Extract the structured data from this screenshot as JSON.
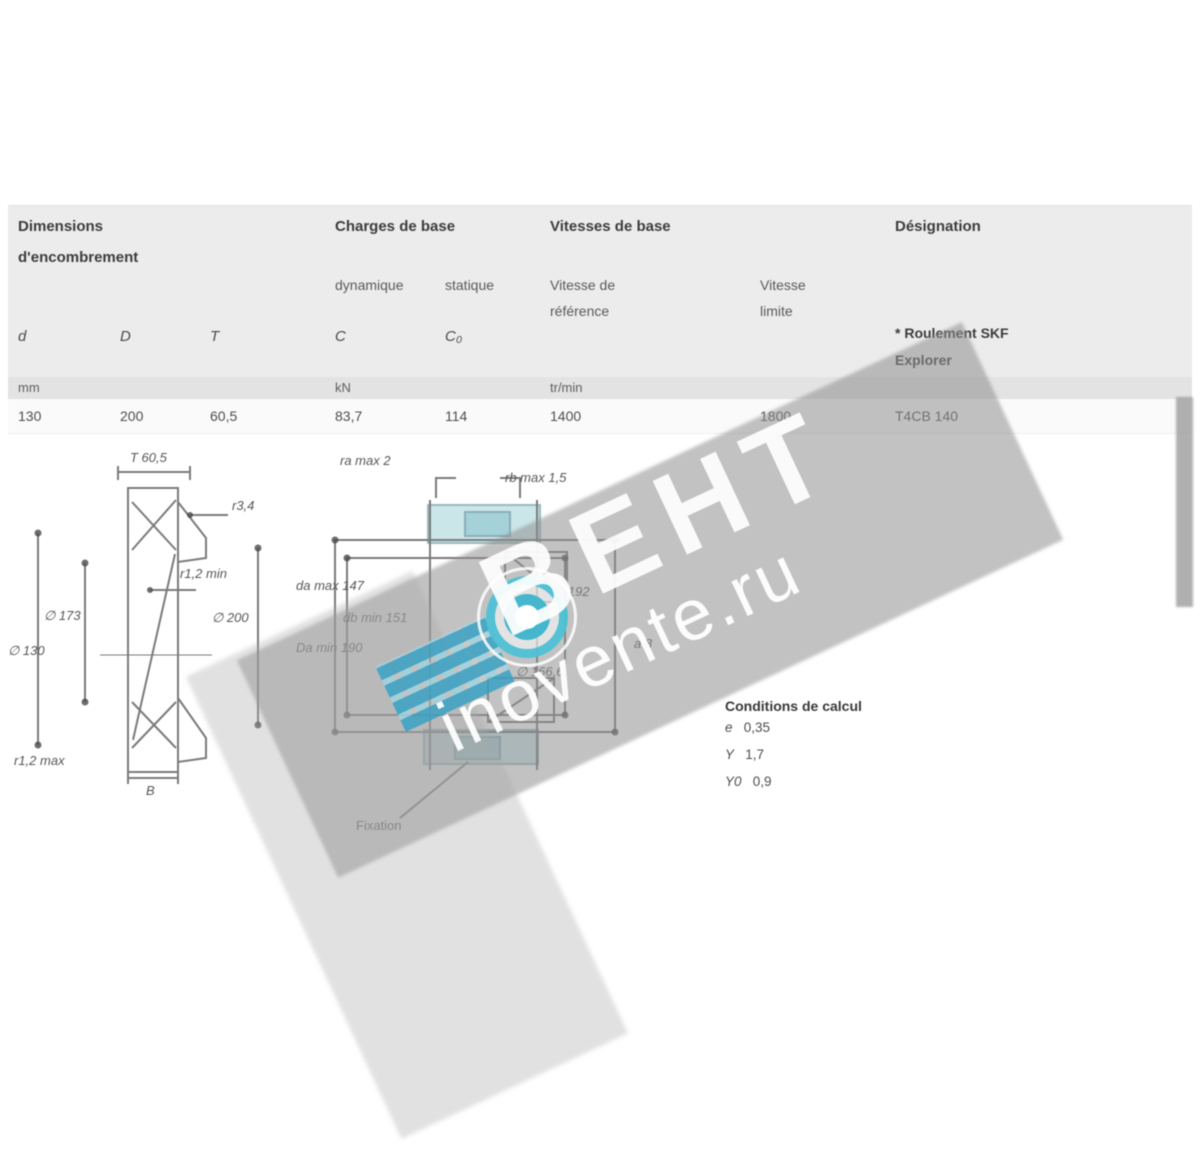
{
  "watermark": {
    "brand": "ВЕНТ",
    "site": "inovente.ru",
    "accent": "#3fb6cc"
  },
  "table": {
    "group1": {
      "title_line1": "Dimensions",
      "title_line2": "d'encombrement"
    },
    "group2": {
      "title": "Charges de base",
      "sub1": "dynamique",
      "sub2": "statique",
      "sym1": "C",
      "sym2": "C₀",
      "unit": "kN"
    },
    "group3": {
      "title": "Vitesses de base",
      "sub1_line1": "Vitesse de",
      "sub1_line2": "référence",
      "sub2_line1": "Vitesse",
      "sub2_line2": "limite",
      "unit": "tr/min"
    },
    "group4": {
      "title": "Désignation",
      "note_line1": "* Roulement SKF",
      "note_line2": "Explorer"
    },
    "sym_d": "d",
    "sym_D": "D",
    "sym_T": "T",
    "unit_mm": "mm",
    "row": {
      "d": "130",
      "D": "200",
      "T": "60,5",
      "C": "83,7",
      "C0": "114",
      "v_ref": "1400",
      "v_lim": "1800",
      "designation": "T4CB 140"
    }
  },
  "calc": {
    "title": "Conditions de calcul",
    "e_label": "e",
    "e_value": "0,35",
    "y_label": "Y",
    "y_value": "1,7",
    "y0_label": "Y0",
    "y0_value": "0,9"
  },
  "drawing_left": {
    "labels": {
      "T": "T 60,5",
      "r34": "r3,4",
      "r12min": "r1,2 min",
      "d1": "∅ 173",
      "d": "∅ 130",
      "D": "∅ 200",
      "r12max": "r1,2 max",
      "B": "B"
    }
  },
  "drawing_mid": {
    "labels": {
      "ra": "ra max 2",
      "rb": "rb max 1,5",
      "da": "da max 147",
      "db": "db min 151",
      "Da": "Da min 190",
      "d2": "∅ 192",
      "a": "a 8",
      "dm": "∅ 166,6",
      "fixation": "Fixation"
    }
  }
}
